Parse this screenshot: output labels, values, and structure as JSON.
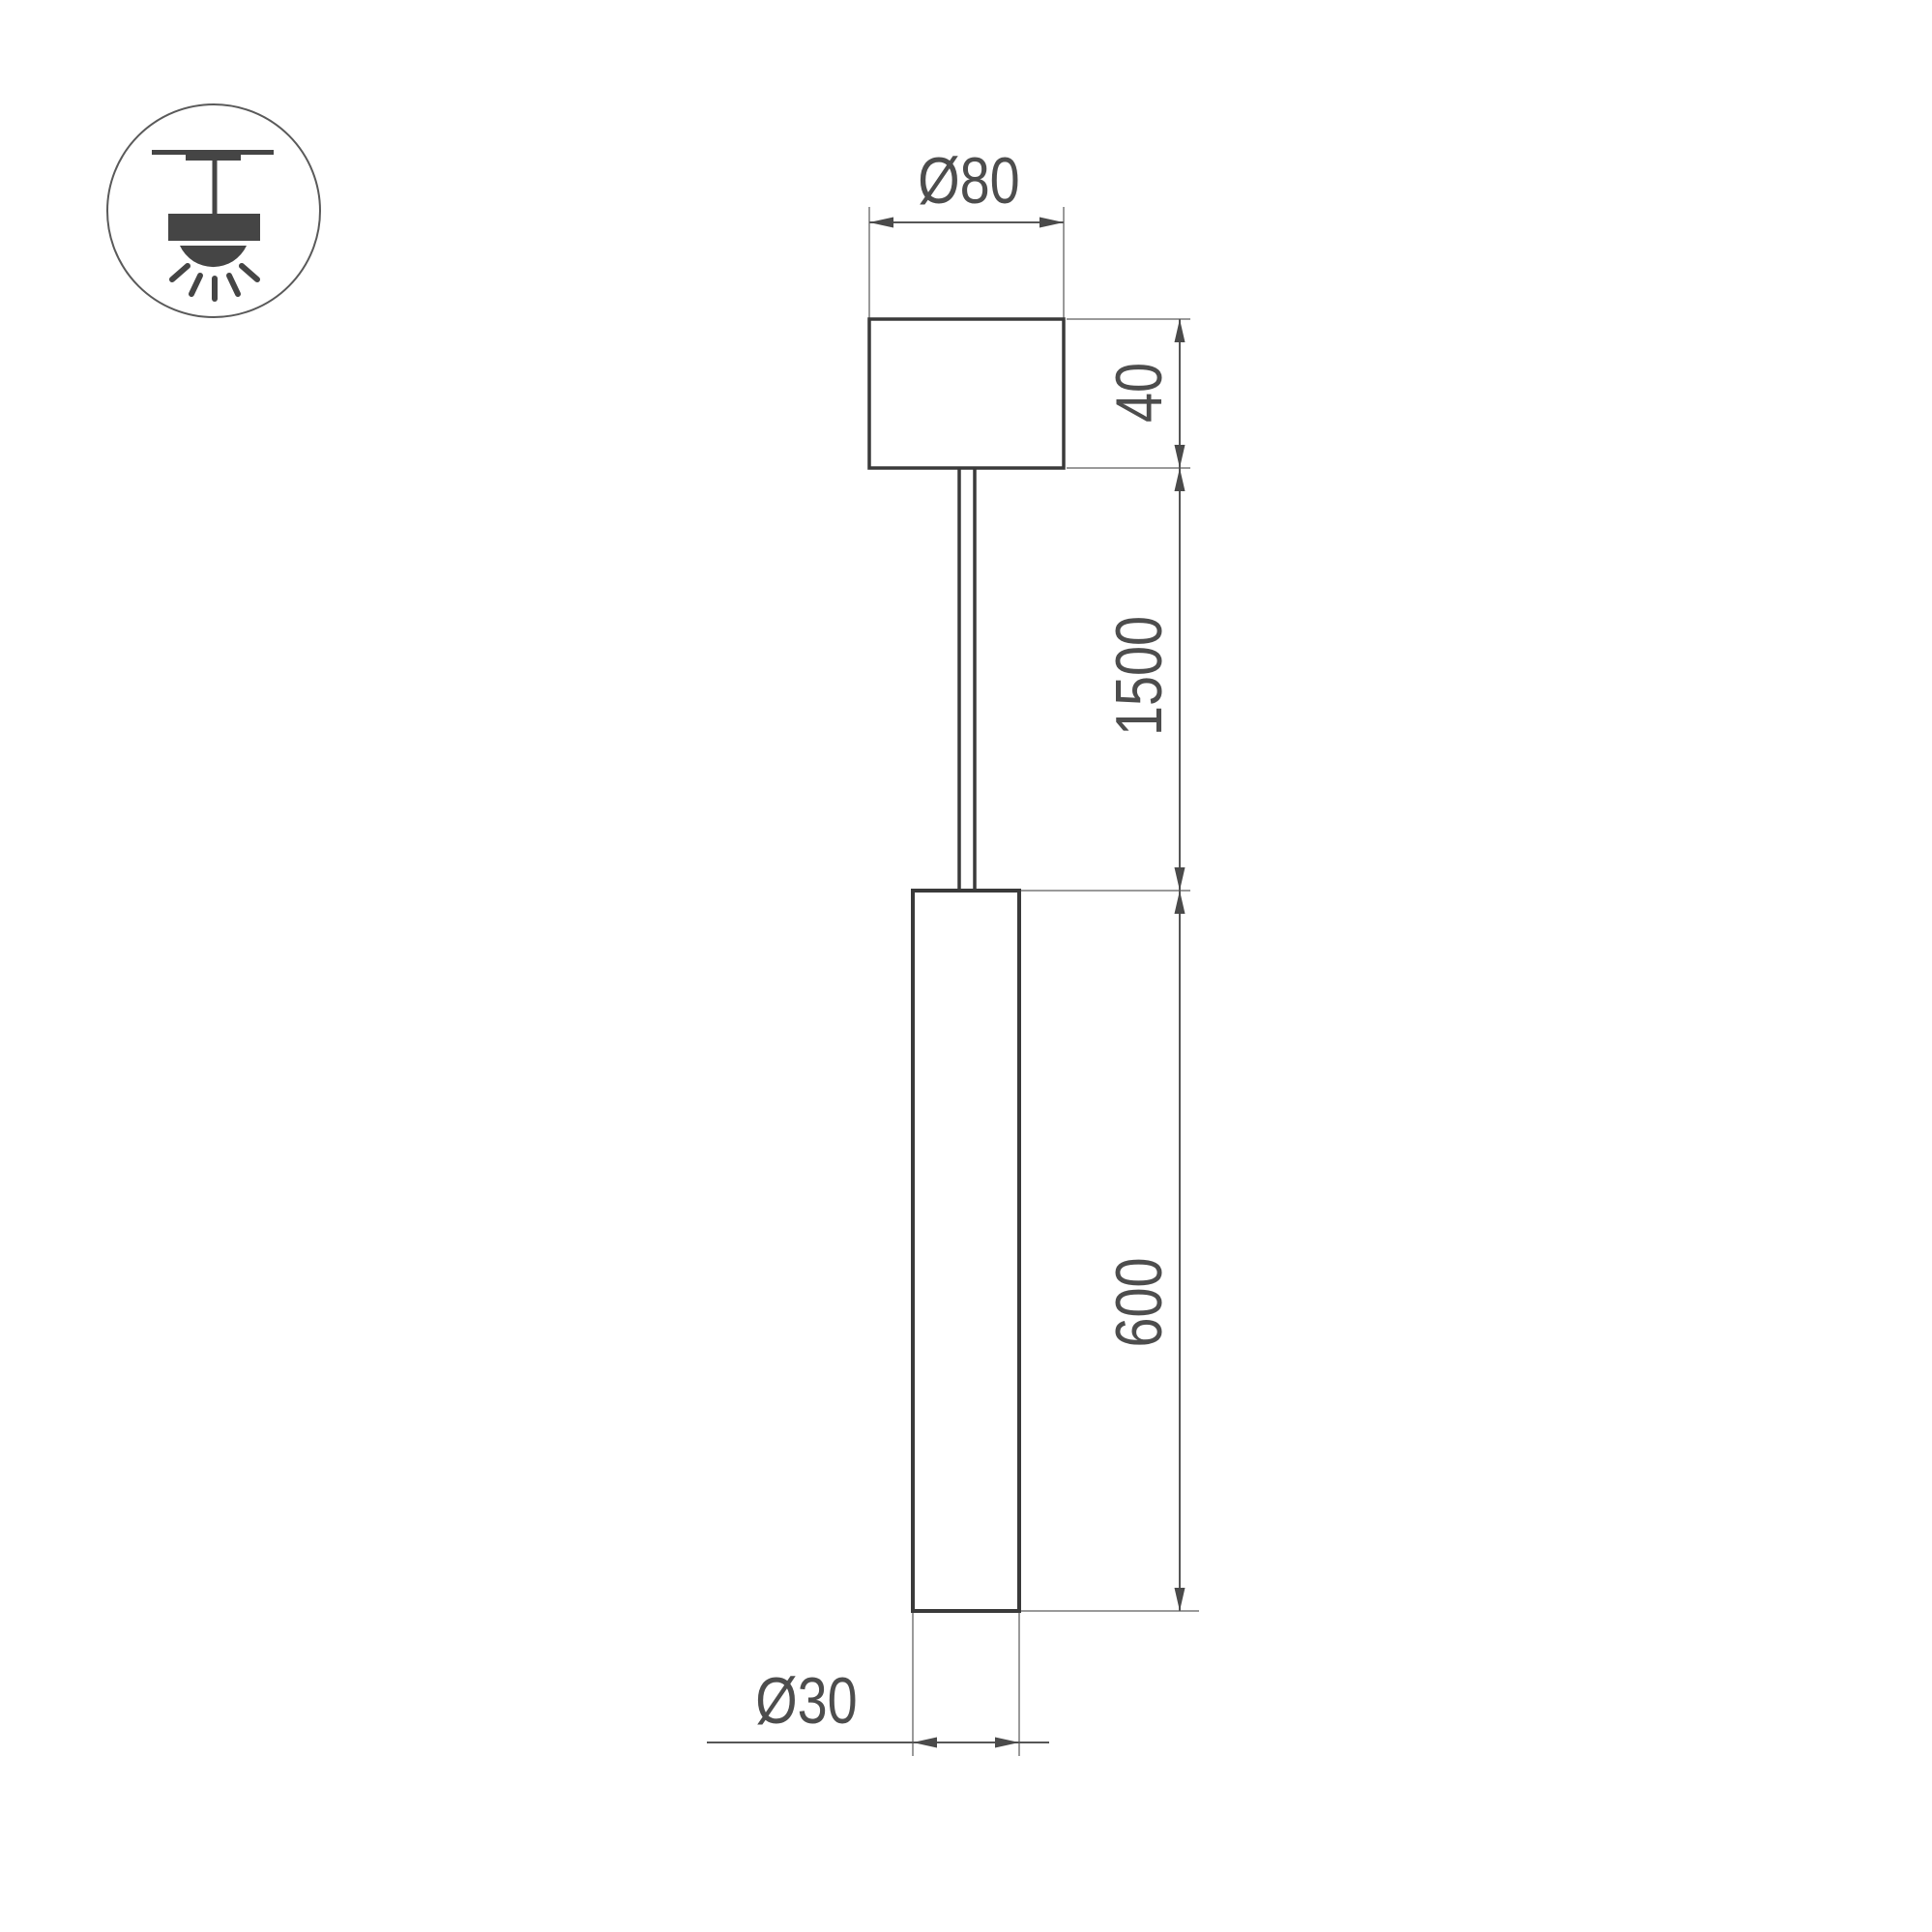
{
  "icon": {
    "name": "pendant-light-icon"
  },
  "dimensions": {
    "canopy_diameter": "Ø80",
    "canopy_height": "40",
    "suspension_length": "1500",
    "tube_length": "600",
    "tube_diameter": "Ø30"
  },
  "colors": {
    "background": "#ffffff",
    "object_line": "#3a3a3a",
    "dimension_line": "#565656",
    "extension_line": "#9a9a9a",
    "arrow": "#4a4a4a",
    "text": "#4d4d4d",
    "icon": "#454545"
  }
}
